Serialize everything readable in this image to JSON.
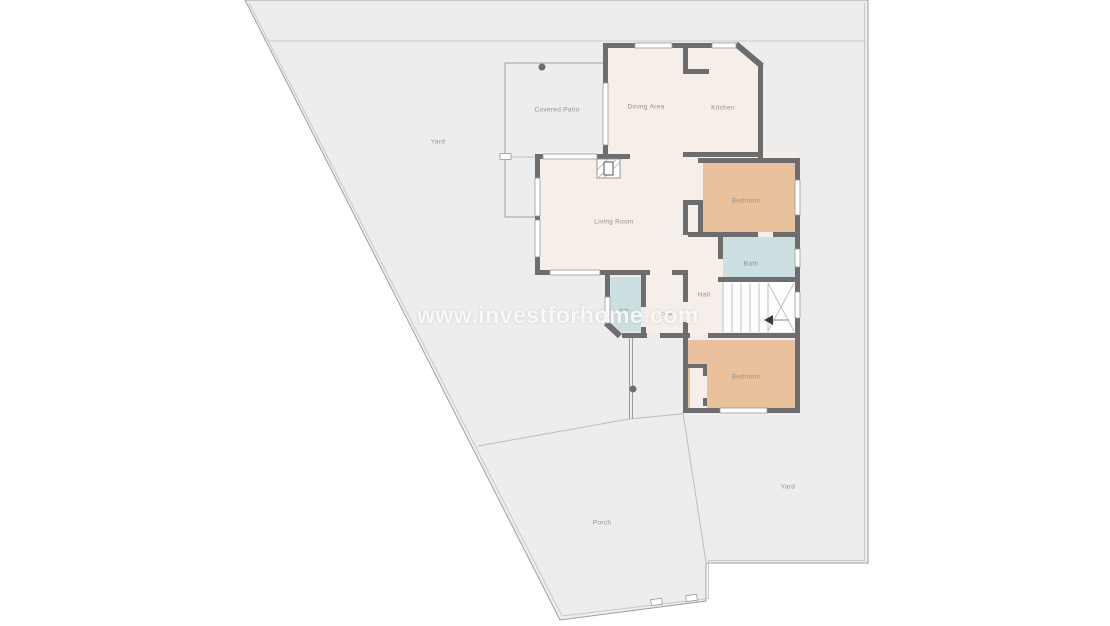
{
  "watermark": {
    "text": "www.investforhome.com"
  },
  "plan": {
    "rooms": [
      {
        "id": "yard-left",
        "label": "Yard"
      },
      {
        "id": "covered-patio",
        "label": "Covered Patio"
      },
      {
        "id": "dining-area",
        "label": "Dining Area"
      },
      {
        "id": "kitchen",
        "label": "Kitchen"
      },
      {
        "id": "living-room",
        "label": "Living Room"
      },
      {
        "id": "bedroom-top",
        "label": "Bedroom"
      },
      {
        "id": "bath",
        "label": "Bath"
      },
      {
        "id": "hall",
        "label": "Hall"
      },
      {
        "id": "bath-small",
        "label": "Bath"
      },
      {
        "id": "foyer",
        "label": "Foyer"
      },
      {
        "id": "bedroom-bottom",
        "label": "Bedroom"
      },
      {
        "id": "yard-right",
        "label": "Yard"
      },
      {
        "id": "porch",
        "label": "Porch"
      }
    ],
    "colors": {
      "wall": "#6d6d6d",
      "room_floor": "#f6eee8",
      "bedroom_floor": "#e9c19c",
      "bathroom_floor": "#ccdfe1",
      "yard": "#ededed",
      "boundary_line": "#a0a0a0",
      "label_text": "#8f8f8f",
      "watermark_text": "#ffffff"
    }
  }
}
